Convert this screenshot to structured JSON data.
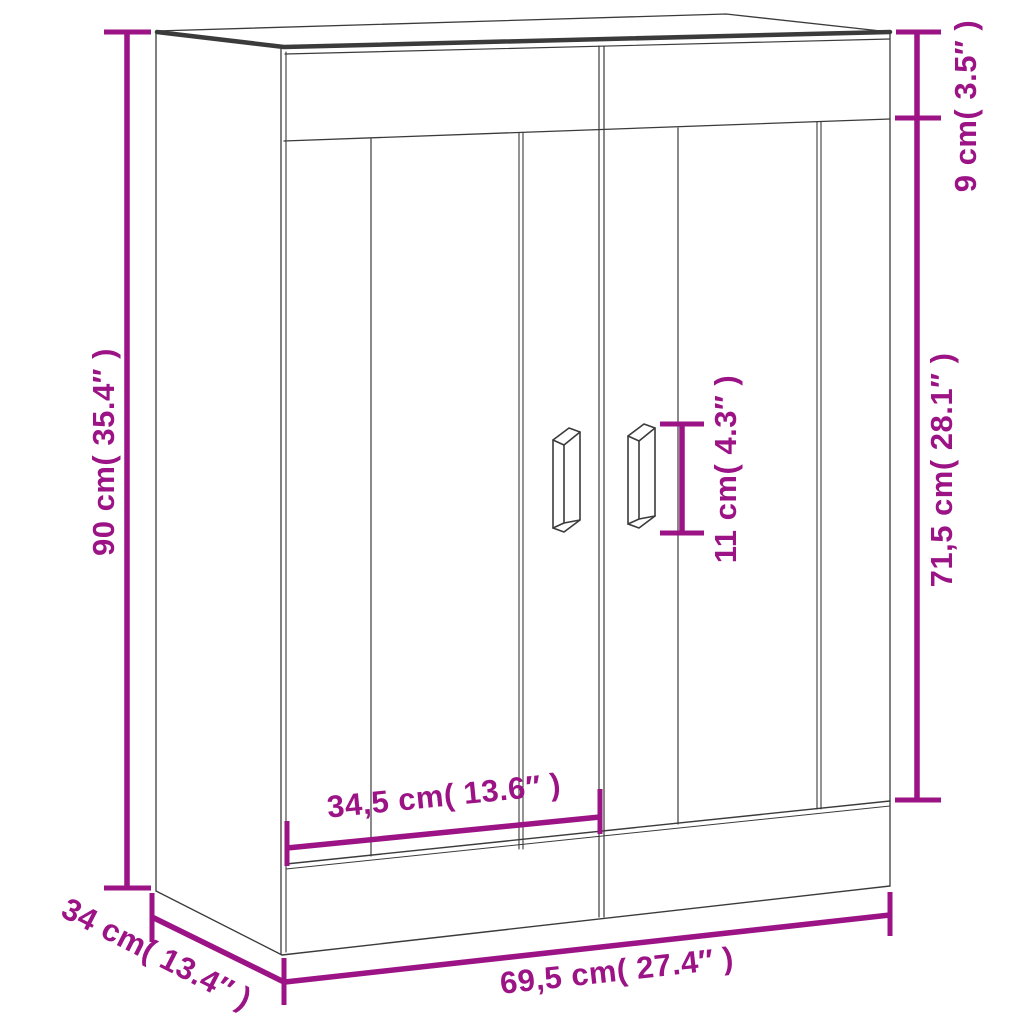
{
  "diagram": {
    "subject": "two-door wall cabinet dimension drawing",
    "colors": {
      "dimension_accent": "#9C1386",
      "outline": "#3B3B3B",
      "background": "#FFFFFF"
    },
    "dimensions": {
      "height": {
        "label": "90 cm( 35.4″ )",
        "value_cm": 90,
        "value_in": 35.4
      },
      "top_rail_height": {
        "label": "9 cm( 3.5″ )",
        "value_cm": 9,
        "value_in": 3.5
      },
      "door_height": {
        "label": "71,5 cm( 28.1″ )",
        "value_cm": 71.5,
        "value_in": 28.1
      },
      "handle_length": {
        "label": "11 cm( 4.3″ )",
        "value_cm": 11,
        "value_in": 4.3
      },
      "door_width": {
        "label": "34,5 cm( 13.6″ )",
        "value_cm": 34.5,
        "value_in": 13.6
      },
      "depth": {
        "label": "34 cm( 13.4″ )",
        "value_cm": 34,
        "value_in": 13.4
      },
      "width": {
        "label": "69,5 cm( 27.4″ )",
        "value_cm": 69.5,
        "value_in": 27.4
      }
    }
  }
}
